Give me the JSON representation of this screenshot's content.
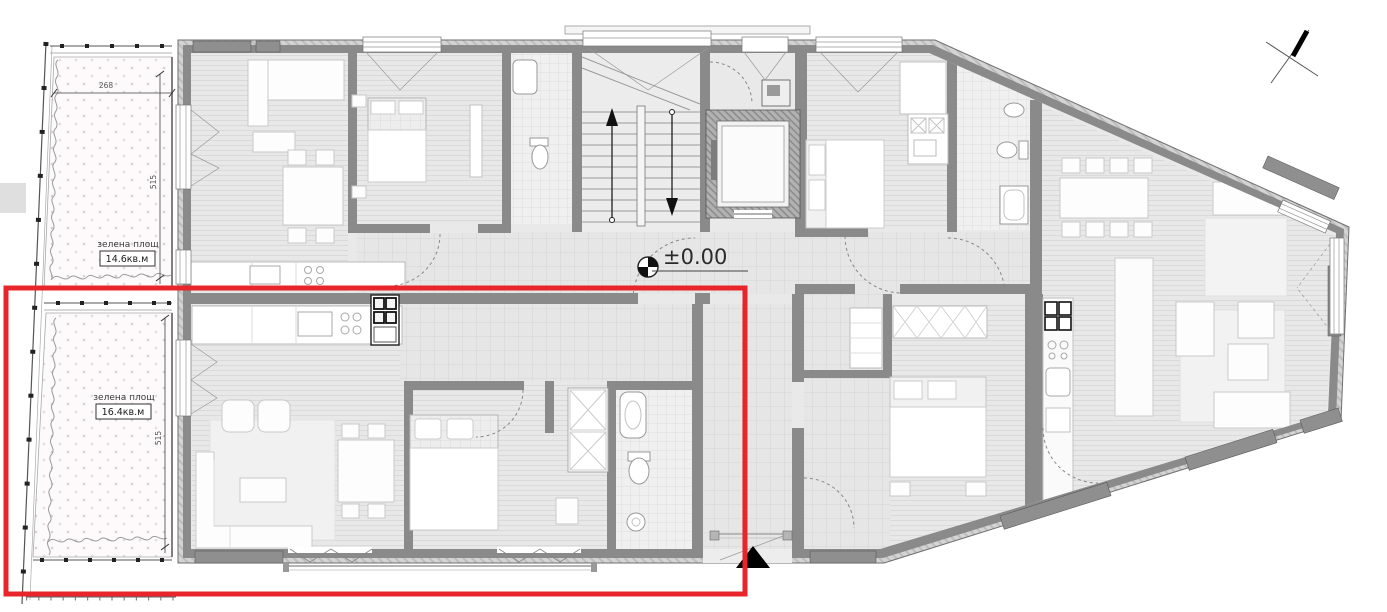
{
  "plan": {
    "elevation_marker": "±0.00",
    "dimensions": {
      "garden_width": "268",
      "garden_height_upper": "515",
      "garden_height_lower": "515"
    },
    "green_areas": [
      {
        "label": "зелена площ",
        "area_value": "14.6кв.м"
      },
      {
        "label": "зелена площ",
        "area_value": "16.4кв.м"
      }
    ],
    "colors": {
      "highlight_red": "#e8252a",
      "wall_gray": "#8a8a8a",
      "wall_finish": "#cccccc",
      "floor": "#e9e9e9",
      "garden_dot": "#dacfd6"
    }
  }
}
